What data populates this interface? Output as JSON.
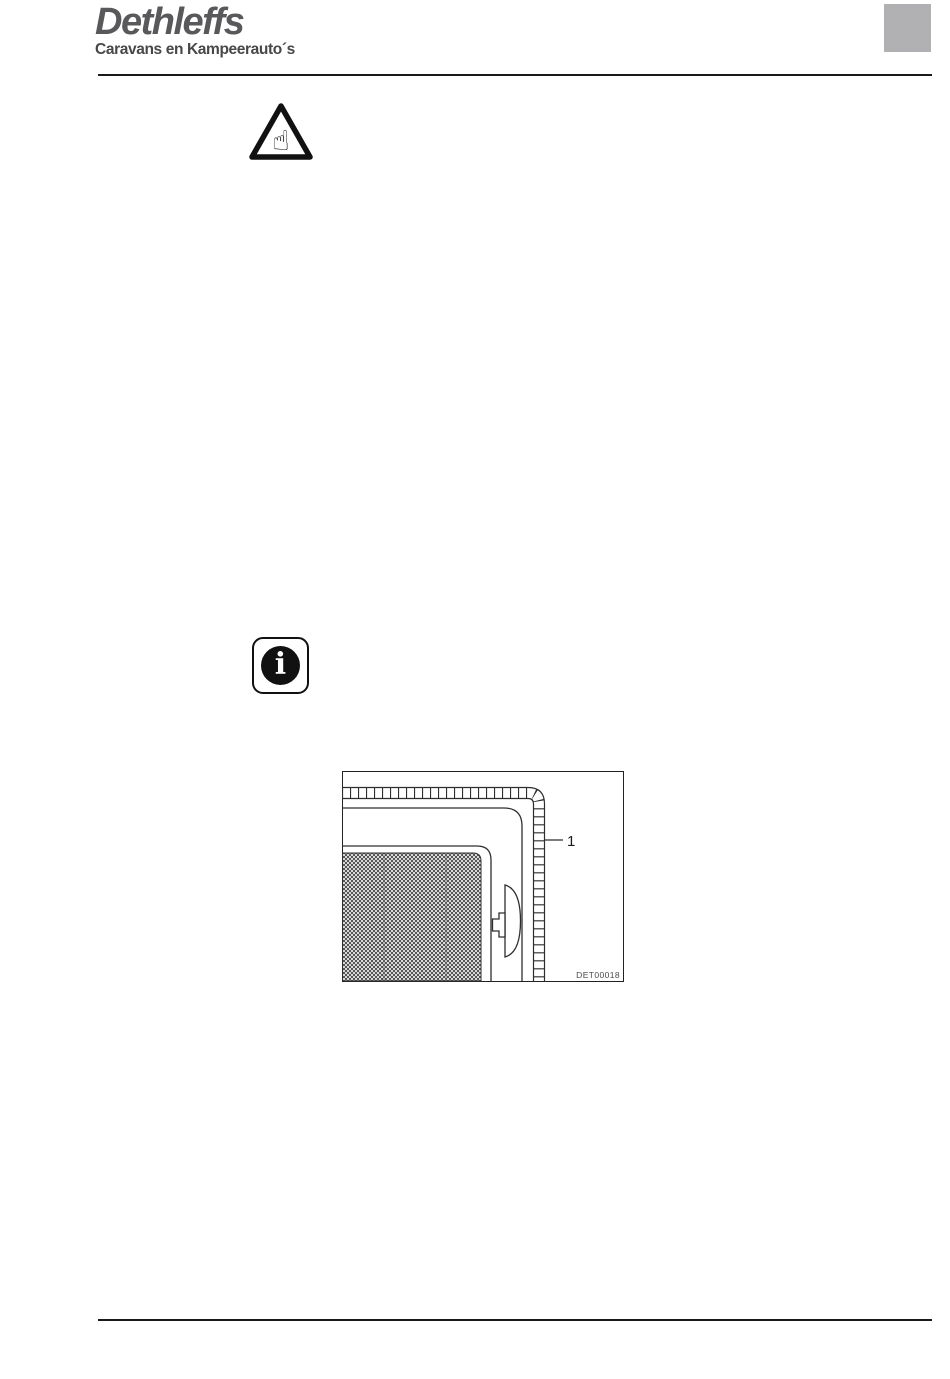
{
  "header": {
    "brand": "Dethleffs",
    "tagline": "Caravans en Kampeerauto´s"
  },
  "icons": {
    "warning": {
      "name": "attention-hand-triangle-icon",
      "glyph": "☝"
    },
    "info": {
      "name": "info-icon",
      "glyph": "i"
    }
  },
  "figure": {
    "callout_label": "1",
    "caption": "DET00018"
  },
  "colors": {
    "brand_gray": "#59595b",
    "tagline_gray": "#48484a",
    "chapter_box_gray": "#b1b1b3",
    "rule_black": "#1a1a1a",
    "drawing_line": "#2e2e2e",
    "caption_gray": "#4a4a4a"
  }
}
